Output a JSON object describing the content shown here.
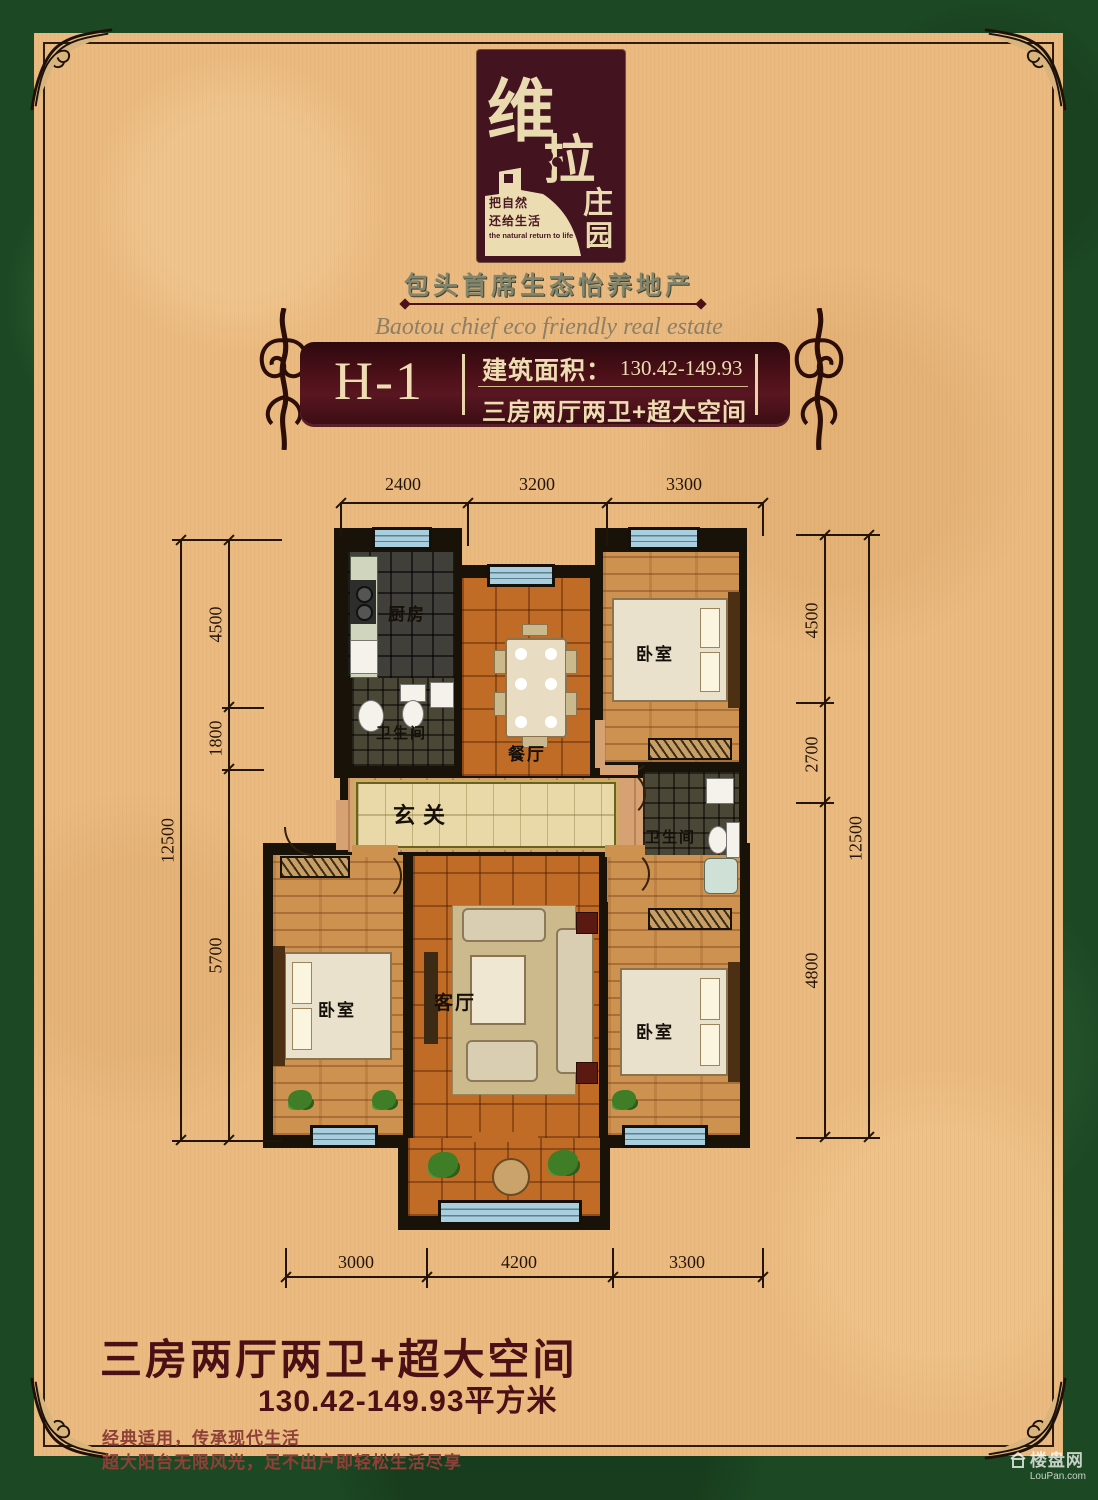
{
  "brand": {
    "logo_char_1": "维",
    "logo_char_2": "拉",
    "logo_char_3": "庄",
    "logo_char_4": "园",
    "slogan_line_1": "把自然",
    "slogan_line_2": "还给生活",
    "slogan_en": "the natural return to life",
    "headline": "包头首席生态怡养地产",
    "tagline_en": "Baotou chief eco friendly real estate"
  },
  "banner": {
    "unit": "H-1",
    "area_label": "建筑面积：",
    "area_value": "130.42-149.93",
    "layout": "三房两厅两卫+超大空间"
  },
  "floorplan": {
    "rooms": {
      "kitchen": "厨房",
      "bath1": "卫生间",
      "dining": "餐厅",
      "bedroom1": "卧室",
      "foyer": "玄关",
      "bath2": "卫生间",
      "bedroom2": "卧室",
      "living": "客厅",
      "bedroom3": "卧室"
    },
    "dims": {
      "top": [
        "2400",
        "3200",
        "3300"
      ],
      "bottom": [
        "3000",
        "4200",
        "3300"
      ],
      "left": [
        "4500",
        "1800",
        "5700"
      ],
      "left_total": "12500",
      "right": [
        "4500",
        "2700",
        "4800"
      ],
      "right_total": "12500"
    }
  },
  "footer": {
    "title": "三房两厅两卫+超大空间",
    "area": "130.42-149.93平方米",
    "desc1": "经典适用，传承现代生活",
    "desc2": "超大阳台无限风光，足不出户即轻松生活尽享"
  },
  "watermark": {
    "name": "楼盘网",
    "url": "LouPan.com"
  },
  "colors": {
    "frame_green": "#1c4823",
    "panel_tan": "#eaba80",
    "maroon": "#431320",
    "banner_maroon": "#4c1018",
    "cream_text": "#eeddb2",
    "window_blue": "#a9cede",
    "wood_orange": "#c06c26",
    "wood_plank": "#cd9250",
    "dim_line": "#241408",
    "footer_red": "#4b1016"
  }
}
